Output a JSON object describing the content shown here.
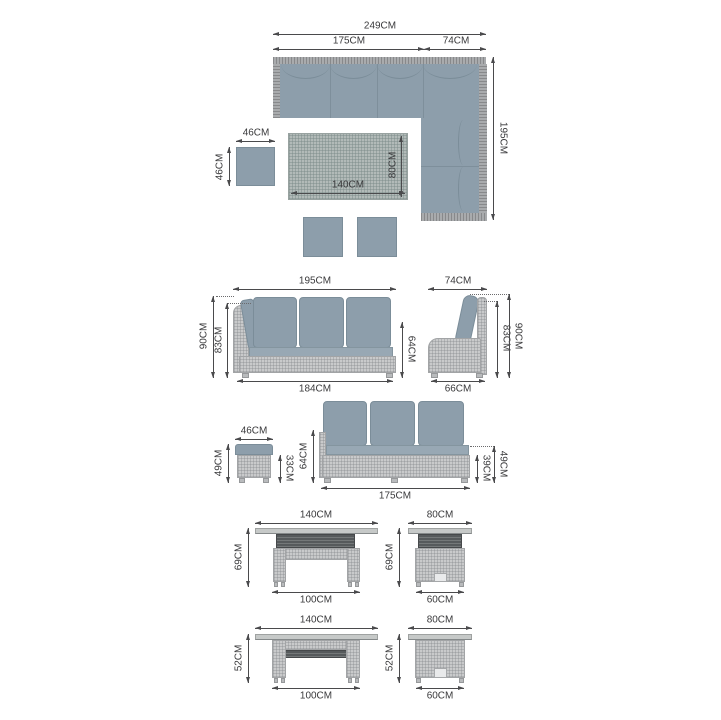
{
  "title": "Garden corner sofa set dimensions diagram",
  "unit": "CM",
  "colors": {
    "background": "#ffffff",
    "cushion": "#8d9eab",
    "seat": "#98a8b4",
    "wicker": "#c9cacb",
    "rattan_edge": "#a9abad",
    "table_grid": "#b2bab8",
    "slats_dark": "#565a5c",
    "dimension_line": "#4a4a4c",
    "label_text": "#39393b"
  },
  "top_view": {
    "sofa": {
      "total_width": "249CM",
      "left_section_width": "175CM",
      "corner_section_width": "74CM",
      "total_depth": "195CM"
    },
    "side_table": {
      "width": "46CM",
      "depth": "46CM"
    },
    "dining_table": {
      "length": "140CM",
      "width": "80CM"
    }
  },
  "sofa_front_view": {
    "width": "195CM",
    "back_height": "90CM",
    "cushion_back_height": "83CM",
    "end_height": "64CM",
    "base_width": "184CM"
  },
  "sofa_side_view": {
    "depth": "74CM",
    "back_height": "83CM",
    "total_height": "90CM",
    "base_depth": "66CM"
  },
  "stool_front_view": {
    "width": "46CM",
    "total_height": "49CM",
    "base_height": "33CM"
  },
  "sofa_section_front_view": {
    "end_height": "64CM",
    "width": "175CM",
    "base_height": "39CM",
    "seat_height": "49CM"
  },
  "table_raised_front_view": {
    "top_width": "140CM",
    "height": "69CM",
    "base_width": "100CM"
  },
  "table_raised_side_view": {
    "top_depth": "80CM",
    "height": "69CM",
    "base_depth": "60CM"
  },
  "table_lowered_front_view": {
    "top_width": "140CM",
    "height": "52CM",
    "base_width": "100CM"
  },
  "table_lowered_side_view": {
    "top_depth": "80CM",
    "height": "52CM",
    "base_depth": "60CM"
  }
}
